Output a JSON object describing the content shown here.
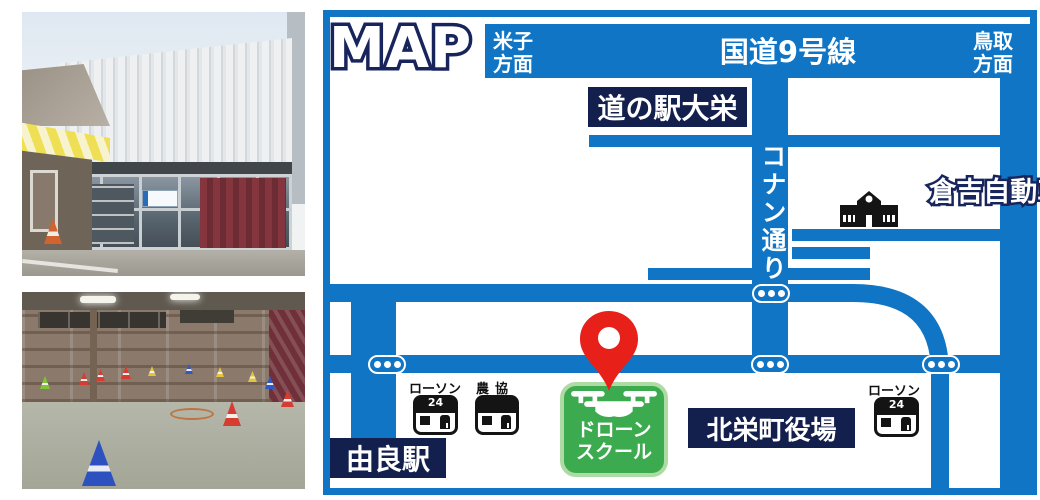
{
  "map": {
    "title": "MAP",
    "route9": {
      "name": "国道9号線",
      "west": [
        "米子",
        "方面"
      ],
      "east": [
        "鳥取",
        "方面"
      ]
    },
    "conan_street": "コナン通り",
    "roadside_station": "道の駅大栄",
    "driving_school": "倉吉自動車学校",
    "yura_station": "由良駅",
    "town_hall": "北栄町役場",
    "stores": {
      "lawson_left": {
        "name": "ローソン",
        "badge": "24"
      },
      "ja_coop": "農協",
      "lawson_right": {
        "name": "ローソン",
        "badge": "24"
      }
    },
    "drone_school": [
      "ドローン",
      "スクール"
    ],
    "colors": {
      "road_blue": "#1075C5",
      "box_navy": "#131F4D",
      "outline_navy": "#17255C",
      "green": "#3CAB4F",
      "green_border": "#AEDBA4",
      "pin_red": "#E7211A"
    }
  }
}
